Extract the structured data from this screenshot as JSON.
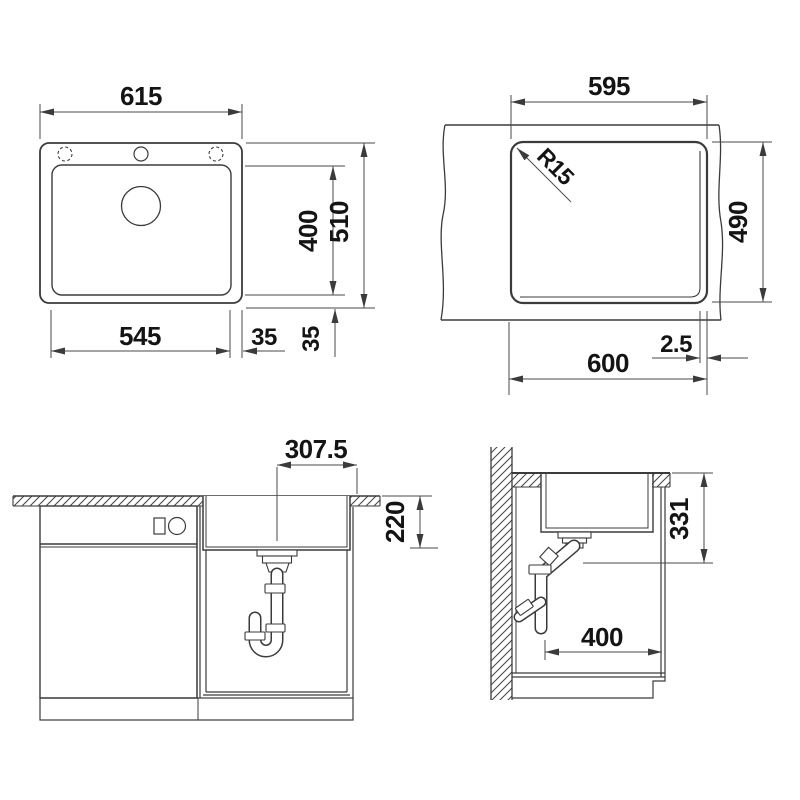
{
  "meta": {
    "background": "#ffffff",
    "line_color": "#3b3b3b",
    "text_color": "#141414"
  },
  "views": {
    "sink_top_view": {
      "overall_width": "615",
      "bowl_depth": "400",
      "overall_depth": "510",
      "bowl_width": "545",
      "right_margin": "35",
      "bottom_margin": "35"
    },
    "countertop_cutout_view": {
      "cutout_width_top": "595",
      "corner_radius": "R15",
      "cutout_depth": "490",
      "cutout_width_bottom": "600",
      "chamfer": "2.5"
    },
    "front_section_view": {
      "drain_offset": "307.5",
      "bowl_inner_depth": "220"
    },
    "side_section_view": {
      "drain_outlet_height": "331",
      "cabinet_width": "400"
    }
  }
}
